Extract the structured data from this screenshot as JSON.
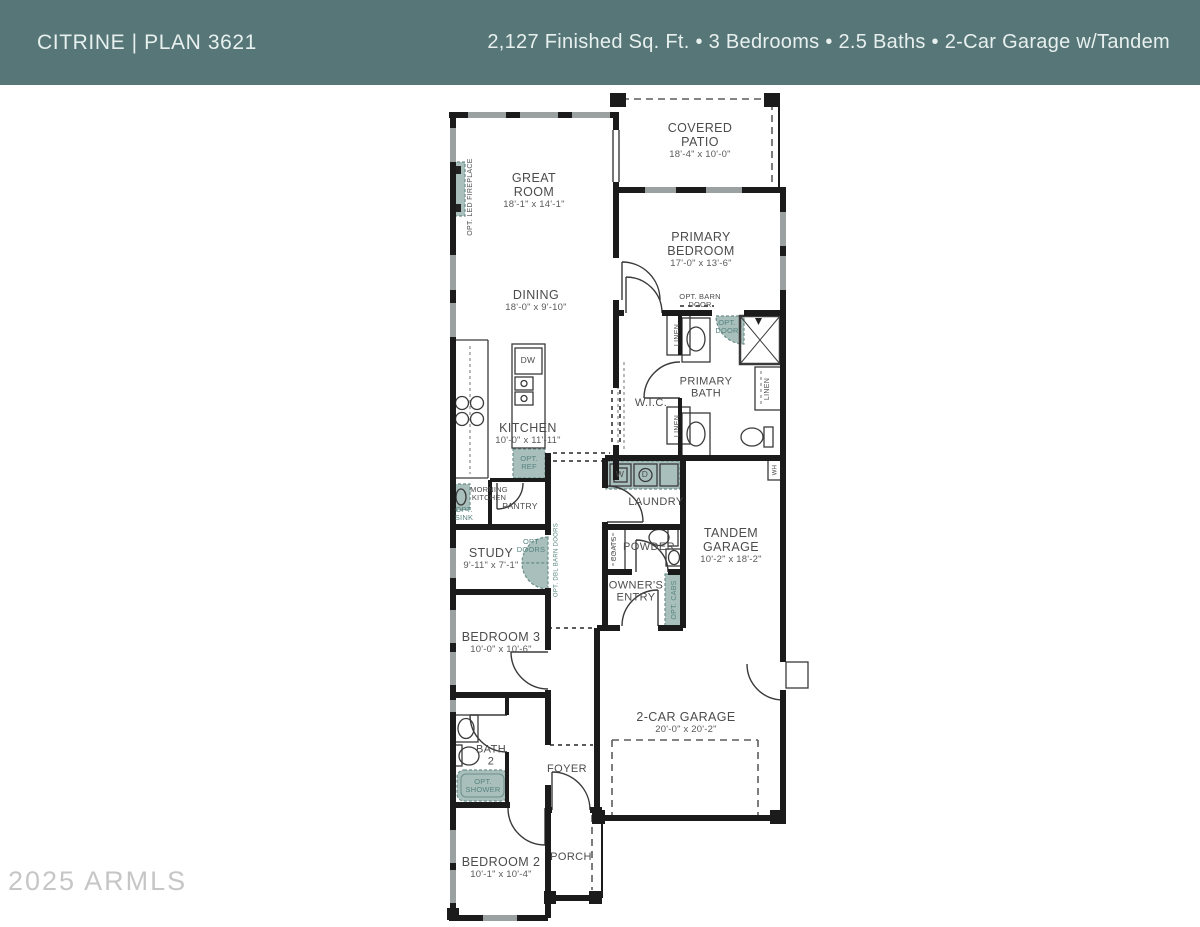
{
  "header": {
    "title": "CITRINE | PLAN 3621",
    "specs": "2,127 Finished Sq. Ft. • 3 Bedrooms • 2.5 Baths • 2-Car Garage w/Tandem"
  },
  "watermark": "2025 ARMLS",
  "colors": {
    "header_bg": "#567677",
    "header_text": "#e8f0ef",
    "wall": "#1b1b1b",
    "window": "#9ba1a1",
    "optional_fill": "#a9bfbc",
    "optional_text": "#55837e"
  },
  "rooms": {
    "covered_patio": {
      "name": "COVERED PATIO",
      "dims": "18'-4\" x 10'-0\""
    },
    "great_room": {
      "name": "GREAT ROOM",
      "dims": "18'-1\" x 14'-1\""
    },
    "primary_bedroom": {
      "name": "PRIMARY BEDROOM",
      "dims": "17'-0\" x 13'-6\""
    },
    "dining": {
      "name": "DINING",
      "dims": "18'-0\" x 9'-10\""
    },
    "kitchen": {
      "name": "KITCHEN",
      "dims": "10'-0\" x 11'-11\""
    },
    "primary_bath": {
      "name": "PRIMARY BATH"
    },
    "wic": {
      "name": "W.I.C."
    },
    "laundry": {
      "name": "LAUNDRY"
    },
    "tandem_garage": {
      "name": "TANDEM GARAGE",
      "dims": "10'-2\" x 18'-2\""
    },
    "powder": {
      "name": "POWDER"
    },
    "owners_entry": {
      "name": "OWNER'S ENTRY"
    },
    "study": {
      "name": "STUDY",
      "dims": "9'-11\" x 7'-1\""
    },
    "bedroom3": {
      "name": "BEDROOM 3",
      "dims": "10'-0\" x 10'-6\""
    },
    "car_garage": {
      "name": "2-CAR GARAGE",
      "dims": "20'-0\" x 20'-2\""
    },
    "bath2": {
      "name": "BATH 2"
    },
    "foyer": {
      "name": "FOYER"
    },
    "porch": {
      "name": "PORCH"
    },
    "bedroom2": {
      "name": "BEDROOM 2",
      "dims": "10'-1\" x 10'-4\""
    }
  },
  "annotations": {
    "opt_led_fireplace": "OPT. LED FIREPLACE",
    "opt_barn_door": "OPT. BARN DOOR",
    "opt_door": "OPT. DOOR",
    "linen": "LINEN",
    "dw": "DW",
    "washer": "W",
    "dryer": "D",
    "wh": "WH",
    "opt_ref": "OPT. REF",
    "morning_kitchen": "MORNING KITCHEN",
    "opt_sink": "OPT. SINK",
    "pantry": "PANTRY",
    "coats": "COATS",
    "opt_cabs": "OPT. CABS",
    "opt_doors": "OPT DOORS",
    "opt_dbl_barn_doors": "OPT. DBL BARN DOORS",
    "opt_shower": "OPT. SHOWER"
  }
}
